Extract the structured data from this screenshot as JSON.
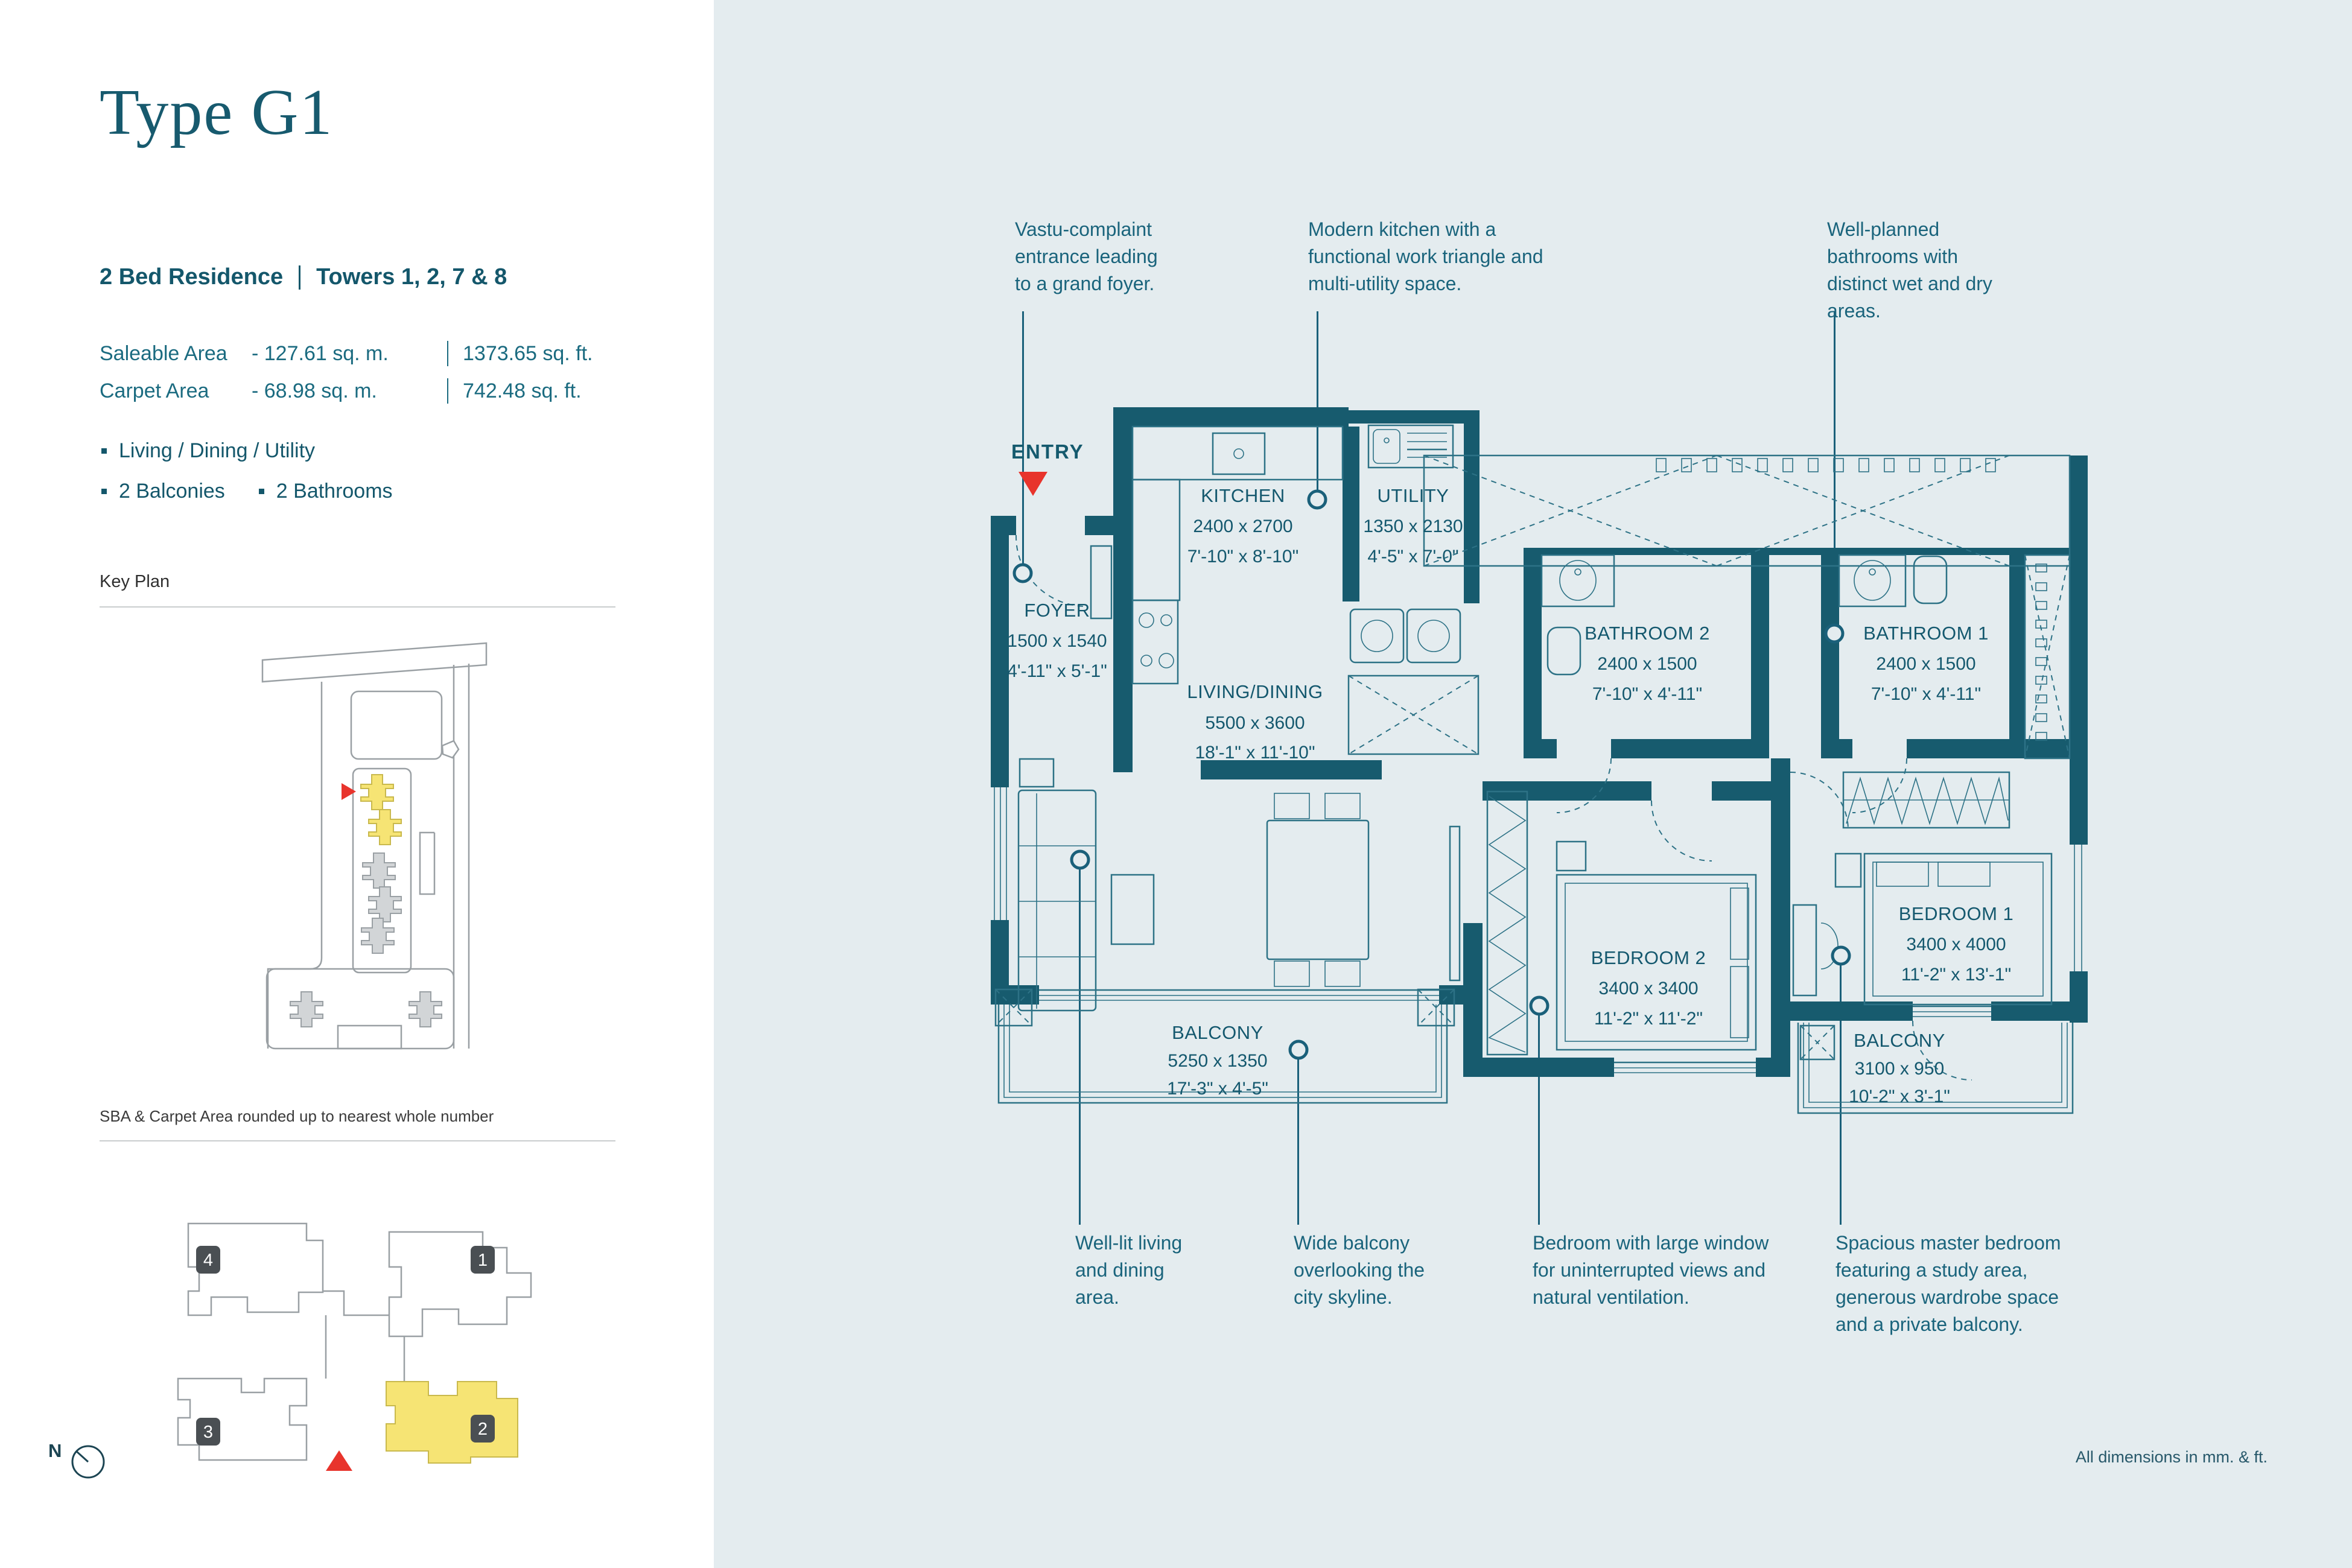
{
  "colors": {
    "teal_wall": "#175b6e",
    "teal_text": "#1a647c",
    "accent_red": "#e8342c",
    "highlight_yellow": "#f6e474",
    "bg_right": "#e4ecef",
    "bg_left": "#ffffff",
    "outline_grey": "#9aa0a4",
    "badge_grey": "#4a4f53"
  },
  "left_panel": {
    "title": "Type G1",
    "residence": "2 Bed Residence",
    "towers": "Towers 1, 2, 7 & 8",
    "areas": [
      {
        "label": "Saleable Area",
        "value": "- 127.61 sq. m.",
        "imperial": "1373.65 sq. ft."
      },
      {
        "label": "Carpet Area",
        "value": "- 68.98 sq. m.",
        "imperial": "742.48 sq. ft."
      }
    ],
    "features": [
      "Living / Dining / Utility",
      "2 Balconies",
      "2 Bathrooms"
    ],
    "key_plan_title": "Key Plan",
    "sba_note": "SBA & Carpet Area rounded up to nearest whole number",
    "north_label": "N",
    "tower_badges": [
      "4",
      "1",
      "3",
      "2"
    ]
  },
  "plan": {
    "entry_label": "ENTRY",
    "dims_note": "All dimensions in mm. & ft.",
    "rooms": [
      {
        "name": "FOYER",
        "mm": "1500 x 1540",
        "ft": "4'-11\" x 5'-1\""
      },
      {
        "name": "KITCHEN",
        "mm": "2400 x 2700",
        "ft": "7'-10\" x 8'-10\""
      },
      {
        "name": "UTILITY",
        "mm": "1350 x 2130",
        "ft": "4'-5\" x 7'-0\""
      },
      {
        "name": "LIVING/DINING",
        "mm": "5500 x 3600",
        "ft": "18'-1\" x 11'-10\""
      },
      {
        "name": "BATHROOM 2",
        "mm": "2400 x 1500",
        "ft": "7'-10\" x 4'-11\""
      },
      {
        "name": "BATHROOM 1",
        "mm": "2400 x 1500",
        "ft": "7'-10\" x 4'-11\""
      },
      {
        "name": "BEDROOM 2",
        "mm": "3400 x 3400",
        "ft": "11'-2\" x 11'-2\""
      },
      {
        "name": "BEDROOM 1",
        "mm": "3400 x 4000",
        "ft": "11'-2\" x 13'-1\""
      },
      {
        "name": "BALCONY",
        "mm": "5250 x 1350",
        "ft": "17'-3\" x 4'-5\""
      },
      {
        "name": "BALCONY",
        "mm": "3100 x 950",
        "ft": "10'-2\" x 3'-1\""
      }
    ]
  },
  "annotations": {
    "top": [
      {
        "text": "Vastu-complaint entrance leading to a grand foyer."
      },
      {
        "text": "Modern kitchen with a functional work triangle and multi-utility space."
      },
      {
        "text": "Well-planned bathrooms with distinct wet and dry areas."
      }
    ],
    "bottom": [
      {
        "text": "Well-lit living and dining area."
      },
      {
        "text": "Wide balcony overlooking the city skyline."
      },
      {
        "text": "Bedroom with large window for uninterrupted views and natural ventilation."
      },
      {
        "text": "Spacious master bedroom featuring a study area, generous wardrobe space and a private balcony."
      }
    ]
  }
}
